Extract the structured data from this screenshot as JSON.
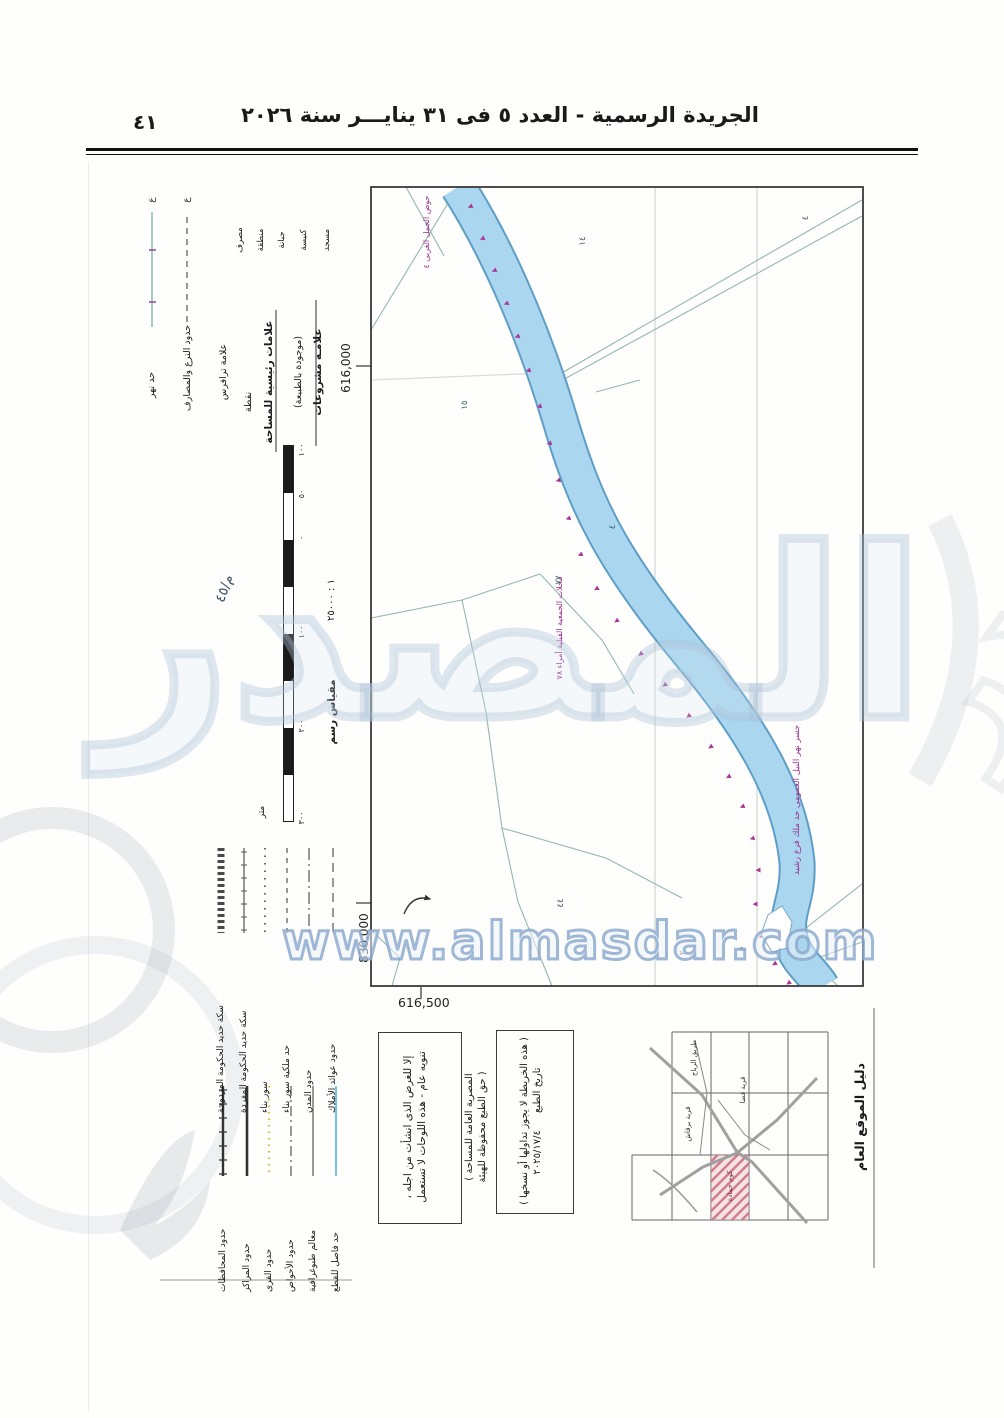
{
  "header": {
    "page_number": "٤١",
    "title": "الجريدة الرسمية - العدد ٥ فى ٣١ ينايـــر سنة ٢٠٢٦"
  },
  "map": {
    "coord_top": "616,000",
    "coord_left": "830,000",
    "coord_bottom": "616,500",
    "basin_note": "حوض الجمل الغربى ٤",
    "canal_note": "جسر نهر النيل العمومى حد ملك فرع رشيد",
    "parcels_note": "محلات الجمعية القبلية أمراء ٧٨",
    "numbers": [
      "١٤",
      "١٥",
      "٤",
      "٧٧",
      "٤٤",
      "٢",
      "٣",
      "٤"
    ]
  },
  "legend_left": {
    "marker_glyph": "ع",
    "river_label": "حد نهر",
    "canals_label": "حدود الترع والمصارف",
    "traverse_label": "علامة ترافرس",
    "point_label": "نقطة",
    "symbols": [
      "مسجد",
      "كنيسة",
      "جبانة",
      "منطقة",
      "مصرف"
    ],
    "projects_heading": "علامـة مشروعات",
    "projects_sub": "(موجودة بالطبيعة)",
    "survey_heading": "علامات رئيسية للمساحة",
    "hand_note": "م/٤٥"
  },
  "scale": {
    "label": "مقياس رسم",
    "ratio": "١ : ٢٥٠٠٠",
    "unit": "متر",
    "ticks": [
      "١٠٠",
      "٥٠",
      "٠",
      "١٠٠",
      "٢٠٠",
      "٣٠٠"
    ]
  },
  "legend_bottom": {
    "group1": [
      "حدود عوائد الأملاك",
      "حدود المدن",
      "حد ملكية سور بناء",
      "سور بناء",
      "سكة حديد الحكومة المفردة",
      "سكة حديد الحكومة المزدوجة"
    ],
    "group2": [
      "حد فاصل للقطع",
      "معالم طبوغرافية",
      "حدود الأحواض",
      "حدود القرى",
      "حدود المراكز",
      "حدود المحافظات"
    ]
  },
  "notes": {
    "tanwih_part1": "تنويه عام - هذه اللوحات لا تستعمل",
    "tanwih_part2": "إلا للغرض الذى انشأت من اجله ،",
    "copyright_part1": "( حق الطبع محفوظة للهيئة",
    "copyright_part2": "المصرية العامة للمساحة )",
    "print_label": "تاريخ الطبع",
    "print_date": "٢٠٢٥/١٧/٤",
    "restriction": "( هذه الخريطة لا يجوز تداولها أو نسخها )"
  },
  "index": {
    "title": "دليل الموقع العام",
    "road_label": "طريق الرياح",
    "village1_label": "قرية قضا",
    "village2_label": "قرية برقاش",
    "hatch_label": "كوم حمادة"
  },
  "watermarks": {
    "url": "www.almasdar.com",
    "brand": "المصدر"
  },
  "colors": {
    "canal_fill": "#aad7ef",
    "canal_edge": "#5e9ec6",
    "survey_magenta": "#a83898",
    "parcel_teal": "#93b7ae",
    "hatch_red": "#cf7b85",
    "village_yellow": "#cfc34d",
    "cut_cyan": "#7fc4da",
    "watermark_blue": "#aac4de"
  }
}
